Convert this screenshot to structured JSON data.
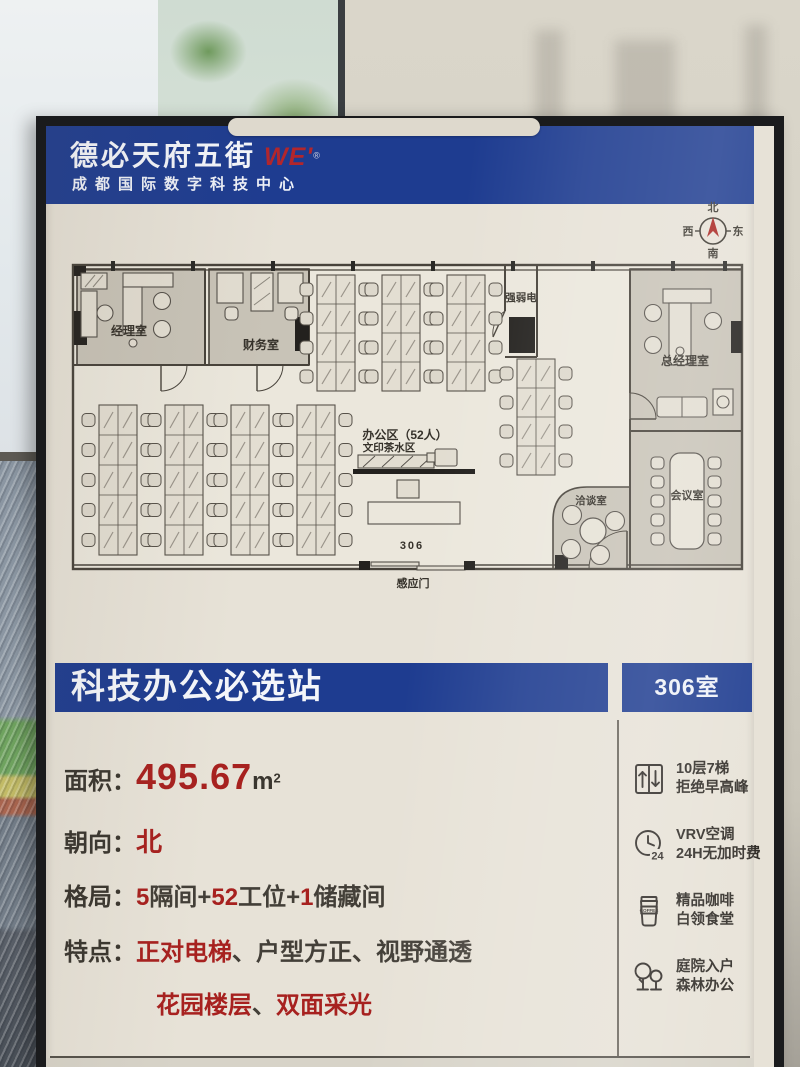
{
  "header": {
    "brand": "德必天府五街",
    "brand_suffix": "WE'",
    "brand_mark": "®",
    "subtitle": "成都国际数字科技中心"
  },
  "compass": {
    "north": "北",
    "south": "南",
    "west": "西",
    "east": "东"
  },
  "floorplan": {
    "rooms": {
      "manager_office": "经理室",
      "finance_office": "财务室",
      "electrical_closet": "强弱电",
      "gm_office": "总经理室",
      "open_office": "办公区（52人）",
      "print_tea_area": "文印茶水区",
      "negotiation_room": "洽谈室",
      "meeting_room": "会议室",
      "room_number": "306",
      "sensor_door": "感应门"
    }
  },
  "banner": {
    "title": "科技办公必选站",
    "room_tag": "306室"
  },
  "specs": {
    "area": {
      "label": "面积：",
      "value": "495.67",
      "unit": "m",
      "sup": "2"
    },
    "orientation": {
      "label": "朝向：",
      "value": "北"
    },
    "layout": {
      "label": "格局：",
      "segments": [
        {
          "text": "5",
          "red": true
        },
        {
          "text": "隔间+",
          "red": false
        },
        {
          "text": "52",
          "red": true
        },
        {
          "text": "工位+",
          "red": false
        },
        {
          "text": "1",
          "red": true
        },
        {
          "text": "储藏间",
          "red": false
        }
      ]
    },
    "features": {
      "label": "特点：",
      "line1": [
        {
          "text": "正对电梯",
          "red": true
        },
        {
          "text": "、",
          "red": false
        },
        {
          "text": "户型方正",
          "red": false
        },
        {
          "text": "、",
          "red": false
        },
        {
          "text": "视野通透",
          "red": false
        }
      ],
      "line2": [
        {
          "text": "花园楼层",
          "red": true
        },
        {
          "text": "、",
          "red": false
        },
        {
          "text": "双面采光",
          "red": true
        }
      ]
    }
  },
  "amenities": [
    {
      "icon": "elevator-icon",
      "line1": "10层7梯",
      "line2": "拒绝早高峰"
    },
    {
      "icon": "clock-24-icon",
      "badge": "24",
      "line1": "VRV空调",
      "line2": "24H无加时费"
    },
    {
      "icon": "coffee-icon",
      "cup_text": "COFFEE",
      "line1": "精品咖啡",
      "line2": "白领食堂"
    },
    {
      "icon": "trees-icon",
      "line1": "庭院入户",
      "line2": "森林办公"
    }
  ],
  "colors": {
    "banner_blue": "#1e3c90",
    "accent_red": "#a7211f",
    "poster_cream": "#e7e2d7"
  }
}
